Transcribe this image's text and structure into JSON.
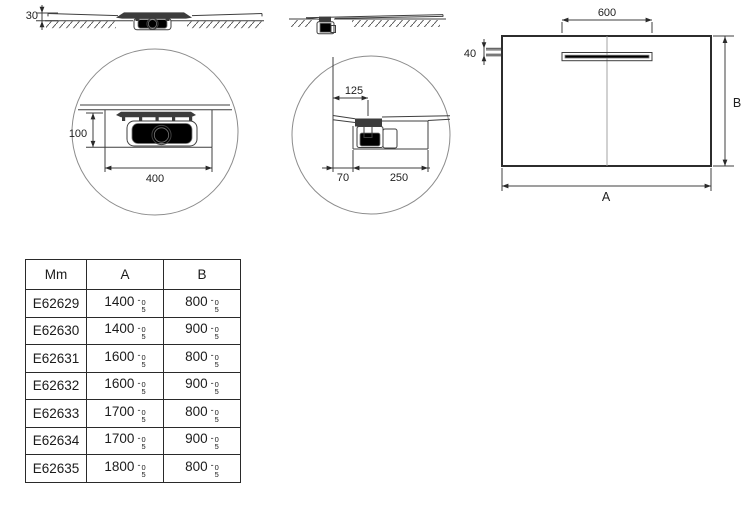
{
  "drawing": {
    "labels": {
      "thickness": "30",
      "channel_length": "600",
      "channel_offset": "40",
      "width_letter": "A",
      "depth_letter": "B",
      "recess_depth": "100",
      "recess_width": "400",
      "drain_offset": "125",
      "edge_gap": "70",
      "drain_recess_width": "250"
    },
    "colors": {
      "line": "#3f3f3f",
      "heavy_outline": "#2c2c2c",
      "detail_circle": "#8c8c8c"
    }
  },
  "table": {
    "unit_header": "Mm",
    "col_a": "A",
    "col_b": "B",
    "tol_minus": "-",
    "tol_top": "0",
    "tol_bottom": "5",
    "rows": [
      {
        "code": "E62629",
        "a": "1400",
        "b": "800"
      },
      {
        "code": "E62630",
        "a": "1400",
        "b": "900"
      },
      {
        "code": "E62631",
        "a": "1600",
        "b": "800"
      },
      {
        "code": "E62632",
        "a": "1600",
        "b": "900"
      },
      {
        "code": "E62633",
        "a": "1700",
        "b": "800"
      },
      {
        "code": "E62634",
        "a": "1700",
        "b": "900"
      },
      {
        "code": "E62635",
        "a": "1800",
        "b": "800"
      }
    ]
  }
}
